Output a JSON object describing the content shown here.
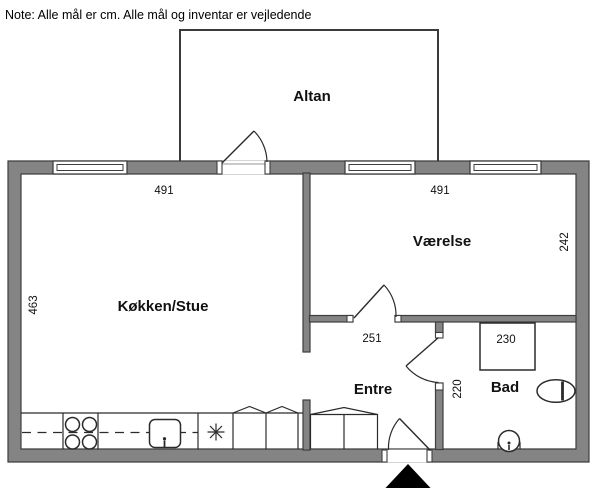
{
  "note": "Note: Alle mål er cm. Alle mål og inventar er vejledende",
  "rooms": {
    "altan": "Altan",
    "kokken_stue": "Køkken/Stue",
    "vaerelse": "Værelse",
    "entre": "Entre",
    "bad": "Bad"
  },
  "measurements": {
    "kokken_stue_width": "491",
    "vaerelse_width": "491",
    "kokken_stue_depth": "463",
    "vaerelse_depth": "242",
    "entre_width": "251",
    "bad_width": "230",
    "bad_depth": "220"
  },
  "colors": {
    "background": "#ffffff",
    "wall_fill": "#848484",
    "wall_outline": "#3e3e3e",
    "drawing_line": "#2b2b2b",
    "entrance_arrow": "#000000"
  },
  "icons": {
    "stove": "stove-burners-icon",
    "kitchen_sink": "kitchen-sink-icon",
    "freezer": "snowflake-icon",
    "toilet": "toilet-icon",
    "washbasin": "washbasin-icon",
    "entrance": "entrance-arrow-icon"
  }
}
